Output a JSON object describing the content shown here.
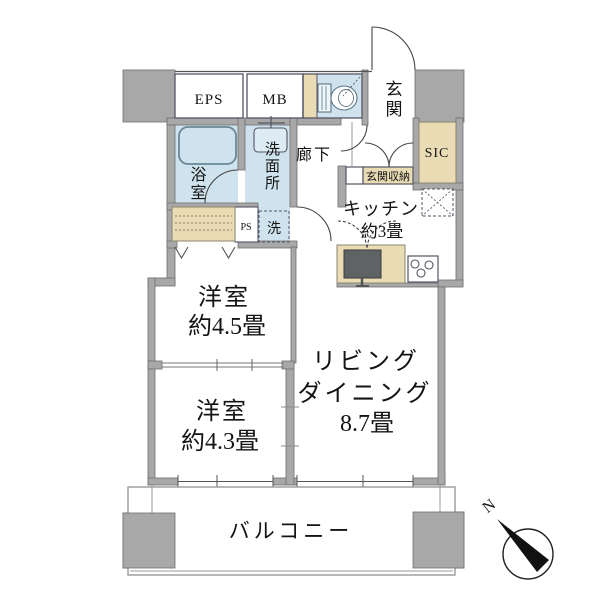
{
  "plan": {
    "utility": {
      "eps": "EPS",
      "mb": "MB",
      "ps": "PS"
    },
    "entrance": {
      "genkan": "玄関",
      "sic": "SIC",
      "storage": "玄関収納",
      "hallway": "廊下"
    },
    "wet_areas": {
      "bath": "浴室",
      "washroom": "洗面所",
      "laundry": "洗"
    },
    "kitchen": {
      "name": "キッチン",
      "size": "約3畳"
    },
    "bedroom1": {
      "name": "洋室",
      "size": "約4.5畳"
    },
    "bedroom2": {
      "name": "洋室",
      "size": "約4.3畳"
    },
    "living": {
      "name_line1": "リビング",
      "name_line2": "ダイニング",
      "size": "8.7畳"
    },
    "balcony": {
      "name": "バルコニー"
    },
    "compass": {
      "north": "N"
    }
  },
  "colors": {
    "wall_gray": "#a8a8a8",
    "water_room_blue": "#cfe3ee",
    "storage_beige": "#e9dcb5",
    "line_dark": "#444444"
  }
}
